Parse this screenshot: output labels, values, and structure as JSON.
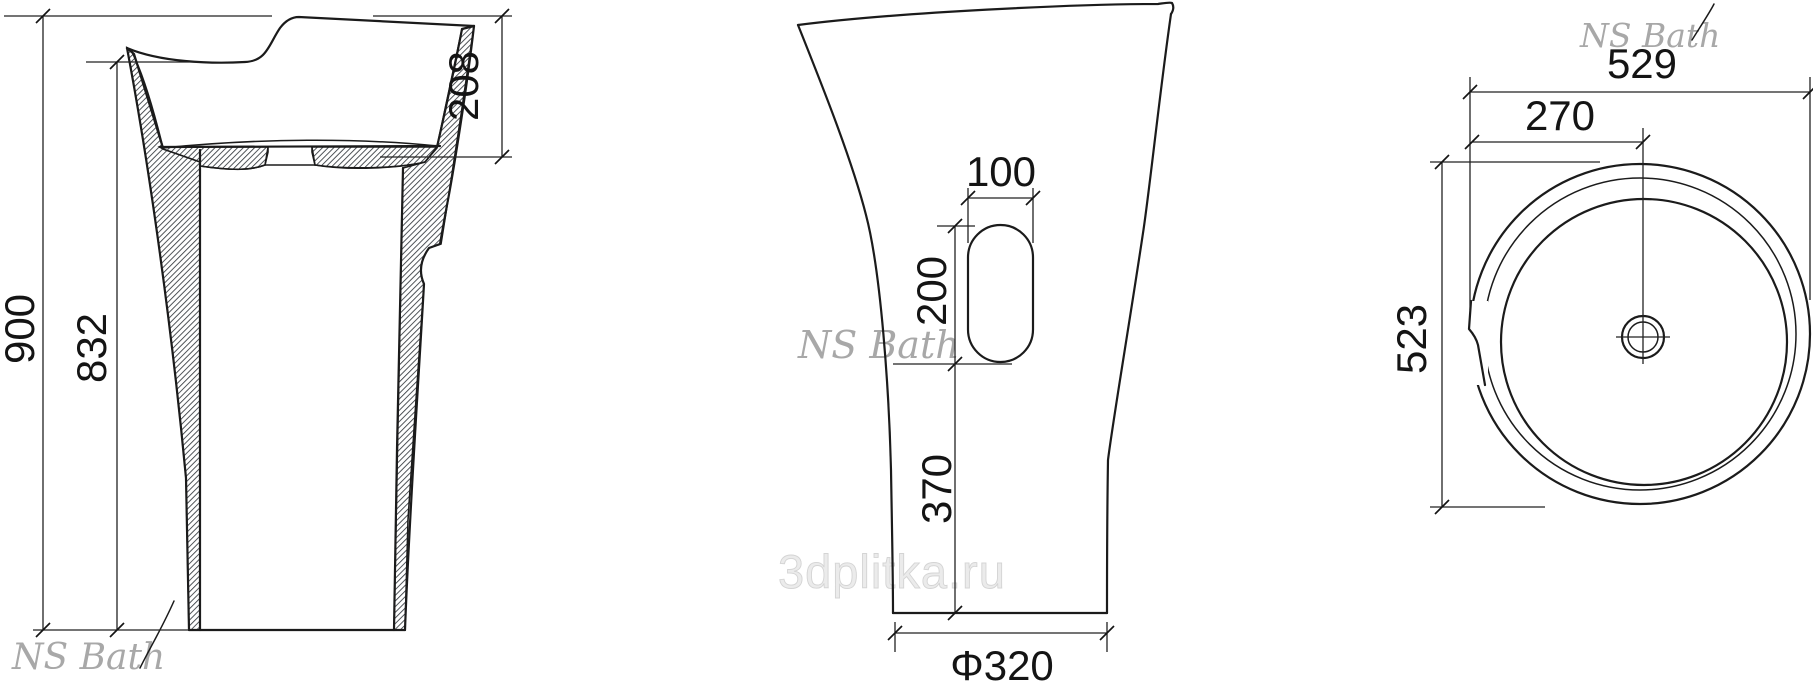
{
  "watermarks": {
    "brand": "NS Bath",
    "site": "3dplitka.ru"
  },
  "side_section_view": {
    "total_height": "900",
    "front_rim_height": "832",
    "basin_depth": "208"
  },
  "front_view": {
    "slot_width": "100",
    "slot_length": "200",
    "slot_bottom_offset": "370",
    "base_diameter": "Φ320"
  },
  "top_view": {
    "overall_width": "529",
    "drain_offset": "270",
    "overall_depth": "523"
  }
}
